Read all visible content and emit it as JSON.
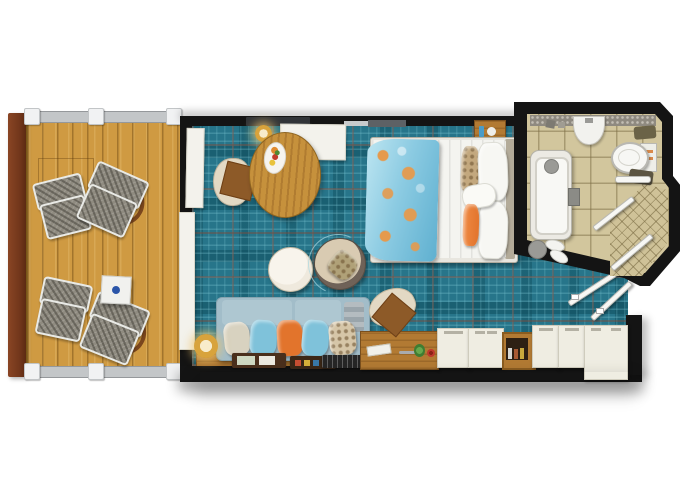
{
  "diagram": {
    "type": "floor-plan",
    "subject": "Cruise cabin / stateroom top-down floor plan with private balcony, living-sleeping area, entry vestibule and bathroom",
    "visible_text": []
  },
  "colors": {
    "wall": "#141414",
    "deck": "#cf9a42",
    "deck-line": "#a6792b",
    "deck-post": "#7c3d1f",
    "rail": "#c3c6c8",
    "rail-post": "#f1f2f3",
    "carpet": "#27758a",
    "carpet-dark": "#15566a",
    "carpet-light": "#7cc6d3",
    "carpet-red": "#7d4a3a",
    "bath-floor": "#d2c69d",
    "bath-line": "#a4976c",
    "white-furn": "#f3f2ec",
    "wood": "#b27a33",
    "wood-dark": "#7a4f1d",
    "table-wood": "#c6913c",
    "sofa": "#a2bdc9",
    "sofa-back": "#aec7d1",
    "pillow-beige": "#d8d2c0",
    "pillow-blue": "#7fc2da",
    "pillow-orange": "#e2742c",
    "pillow-pattern": "#d6c6a8",
    "bed-white": "#f4f4f0",
    "throw-blue": "#8ccbe2",
    "throw-orange": "#e59a4d",
    "lamp-gold": "#d8a33c",
    "cabinet": "#efede2",
    "ottoman": "#efe9dd",
    "chair-beige": "#e3d9c4",
    "seat-brown": "#8d5a28",
    "tub-white": "#f8f8f5",
    "fixture-gray": "#9a9a96",
    "accent-dot": "#2b55a8",
    "glass": "#f7f7f4"
  },
  "rooms": {
    "balcony": {
      "label": "Private balcony: wood plank deck, four woven lounge chairs, white side table with blue emblem, railing on three sides"
    },
    "living": {
      "label": "Main cabin: teal plaid carpet, oval dining table with fruit plate, white desk with TV, double bed with patterned throw, sofa with five pillows, round ottoman and lounge chair, wood vanity and console"
    },
    "bathroom": {
      "label": "Bathroom: beige tile floor, bathtub, washbasin counter, toilet, chamfered corner shower with glass panels, slippers and mat"
    },
    "entry": {
      "label": "Entry vestibule: wardrobe cabinets, minibar shelf, corner cabinet, inward-swinging entry and bathroom doors"
    }
  },
  "furniture": {
    "deck_chair": {
      "label": "Woven sling deck chair"
    },
    "lounger": {
      "label": "Woven deck lounger with curved wood arm"
    },
    "side_table": {
      "label": "Balcony side table with blue emblem"
    },
    "sliding_door": {
      "label": "Sliding balcony door with curtain"
    },
    "dining_table": {
      "label": "Oval wood dining table with fruit plate"
    },
    "dining_chair": {
      "label": "Dining chair with brown seat cushion"
    },
    "desk": {
      "label": "White desk console with TV above"
    },
    "desk_lamp": {
      "label": "Gold table lamp"
    },
    "nightstand": {
      "label": "Wood nightstand with toiletries"
    },
    "bed": {
      "label": "Double bed, white duvet, blue-orange throw, orange lumbar pillow"
    },
    "ottoman": {
      "label": "Round cream ottoman"
    },
    "round_chair": {
      "label": "Round lounge chair with patterned pillow"
    },
    "sofa": {
      "label": "Sofa with beige, blue, orange, blue and floral pillows"
    },
    "floor_lamp": {
      "label": "Gold floor lamp"
    },
    "console_shelf": {
      "label": "Wood console shelf with trays"
    },
    "vanity": {
      "label": "Wood vanity desk with brush, shears, greens and rose"
    },
    "vanity_chair": {
      "label": "Shearling chair with brown seat"
    },
    "wardrobe": {
      "label": "White wardrobe cabinet"
    },
    "minibar": {
      "label": "Minibar shelf with bottles"
    },
    "corner_cabinet": {
      "label": "White corner cabinet unit"
    },
    "tub": {
      "label": "Bathtub with faucet"
    },
    "sink": {
      "label": "Washbasin on counter"
    },
    "toilet": {
      "label": "Toilet with tank"
    },
    "shower": {
      "label": "Corner shower with fine tile and glass"
    },
    "grab_bar": {
      "label": "Towel bar"
    },
    "mat": {
      "label": "Bath mat and slippers"
    },
    "bath_door": {
      "label": "Bathroom door swing"
    },
    "entry_door": {
      "label": "Cabin entry door swing"
    }
  }
}
